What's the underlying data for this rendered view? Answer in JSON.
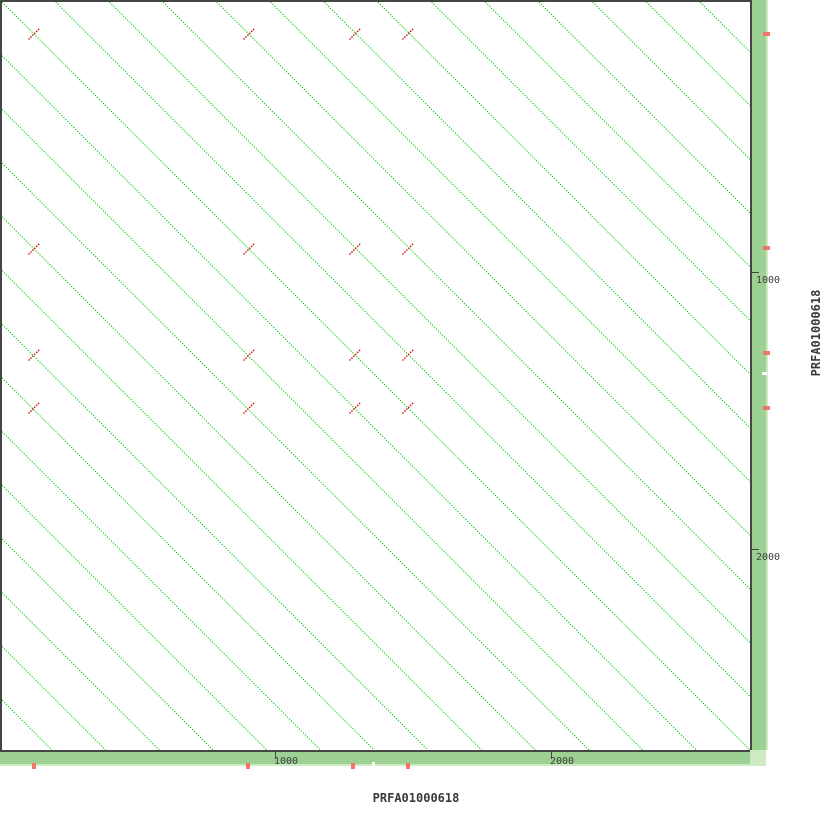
{
  "app": {
    "type": "dotplot-viewer"
  },
  "sequence": {
    "name": "PRFA01000618"
  },
  "colors": {
    "diagonal_line": "#00CC00",
    "inverted_match": "#CE1212",
    "bar_green": "#9CD193",
    "bar_green_light": "#CDEAC2",
    "position_marker": "#F4756B",
    "frame": "#454545",
    "label_text": "#3A3A3A",
    "background": "#FFFFFF"
  },
  "plot": {
    "interior_px": 748,
    "origin_px": 2,
    "diagonal_spacing_px": 53.7,
    "diagonals_each_side": 13,
    "line_dash": "1.3 1.5",
    "red_mark_half_len_px": 5.5
  },
  "x_axis": {
    "label": "PRFA01000618",
    "ticks": [
      {
        "label": "1000",
        "px": 275
      },
      {
        "label": "2000",
        "px": 551
      }
    ]
  },
  "y_axis": {
    "label": "PRFA01000618",
    "ticks": [
      {
        "label": "1000",
        "px": 272
      },
      {
        "label": "2000",
        "px": 549
      }
    ]
  },
  "features": {
    "inverted_repeat_grid_px": [
      34,
      249,
      355,
      408
    ],
    "bar_marker_x_px": [
      34,
      248,
      353,
      408
    ],
    "bar_marker_y_px": [
      34,
      248,
      353,
      408
    ],
    "white_tick_px": 373
  },
  "chart_data": {
    "type": "scatter",
    "subtype": "dotplot-self-alignment",
    "title": "",
    "xlabel": "PRFA01000618",
    "ylabel": "PRFA01000618",
    "x_range_bp": [
      0,
      2720
    ],
    "y_range_bp": [
      0,
      2720
    ],
    "x_ticks_bp": [
      1000,
      2000
    ],
    "y_ticks_bp": [
      1000,
      2000
    ],
    "grid": false,
    "legend": "none",
    "description": "Self dotplot: solid main diagonal plus parallel forward-repeat diagonals at ~195 bp period spanning the whole sequence; short reverse-strand (inverted repeat) matches drawn perpendicular.",
    "tandem_repeat_period_bp": 195,
    "forward_diagonal_offsets_bp": [
      -2535,
      -2340,
      -2145,
      -1950,
      -1755,
      -1560,
      -1365,
      -1170,
      -975,
      -780,
      -585,
      -390,
      -195,
      0,
      195,
      390,
      585,
      780,
      975,
      1170,
      1365,
      1560,
      1755,
      1950,
      2145,
      2340,
      2535
    ],
    "inverted_repeat_positions_bp": [
      123,
      902,
      1286,
      1478
    ],
    "inverted_repeat_pairs_bp": "all 16 combinations of x,y in [123, 902, 1286, 1478]"
  }
}
